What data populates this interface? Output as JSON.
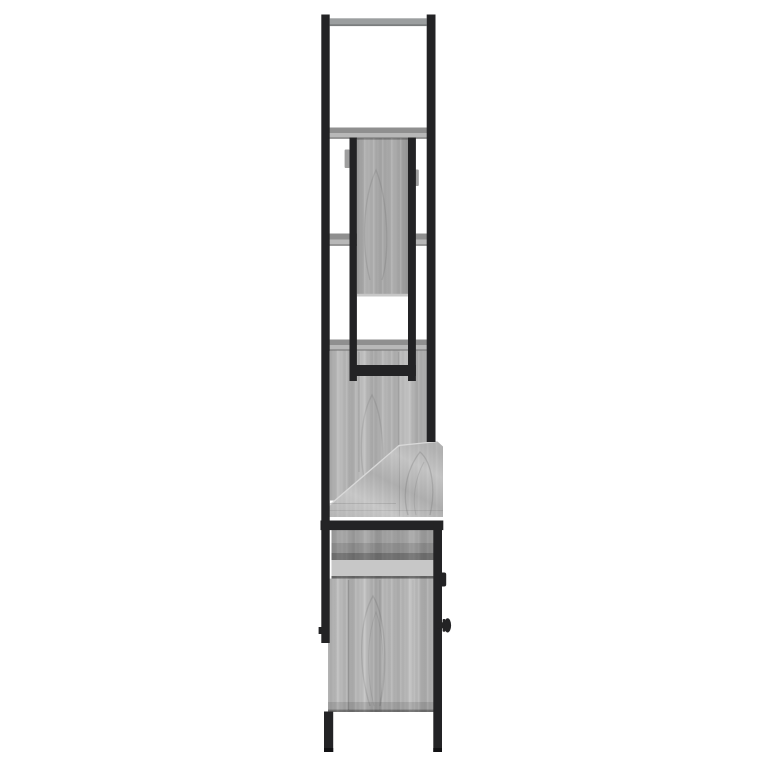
{
  "image": {
    "alt": "Side view product photo of a grey sonoma oak and black steel furniture set: tall open frame with shelves and mirror panel, sloped middle top, and base cabinet with door, round knob and legs on a white background"
  },
  "palette": {
    "background": "#ffffff",
    "metal_black": "#232325",
    "metal_dark": "#121214",
    "steel_grey": "#9b9e9f",
    "steel_grey_shadow": "#7a7d7e",
    "wood_base": "#b6b6b6",
    "wood_light": "#c7c7c7",
    "wood_mid": "#a9a9a9",
    "panel_wood": "#a3a3a3",
    "shelf_top": "#8f8f8f",
    "shelf_front": "#b8b8b8",
    "shelf_edge": "#6f6f6f",
    "fitting_grey": "#9e9e9e"
  }
}
